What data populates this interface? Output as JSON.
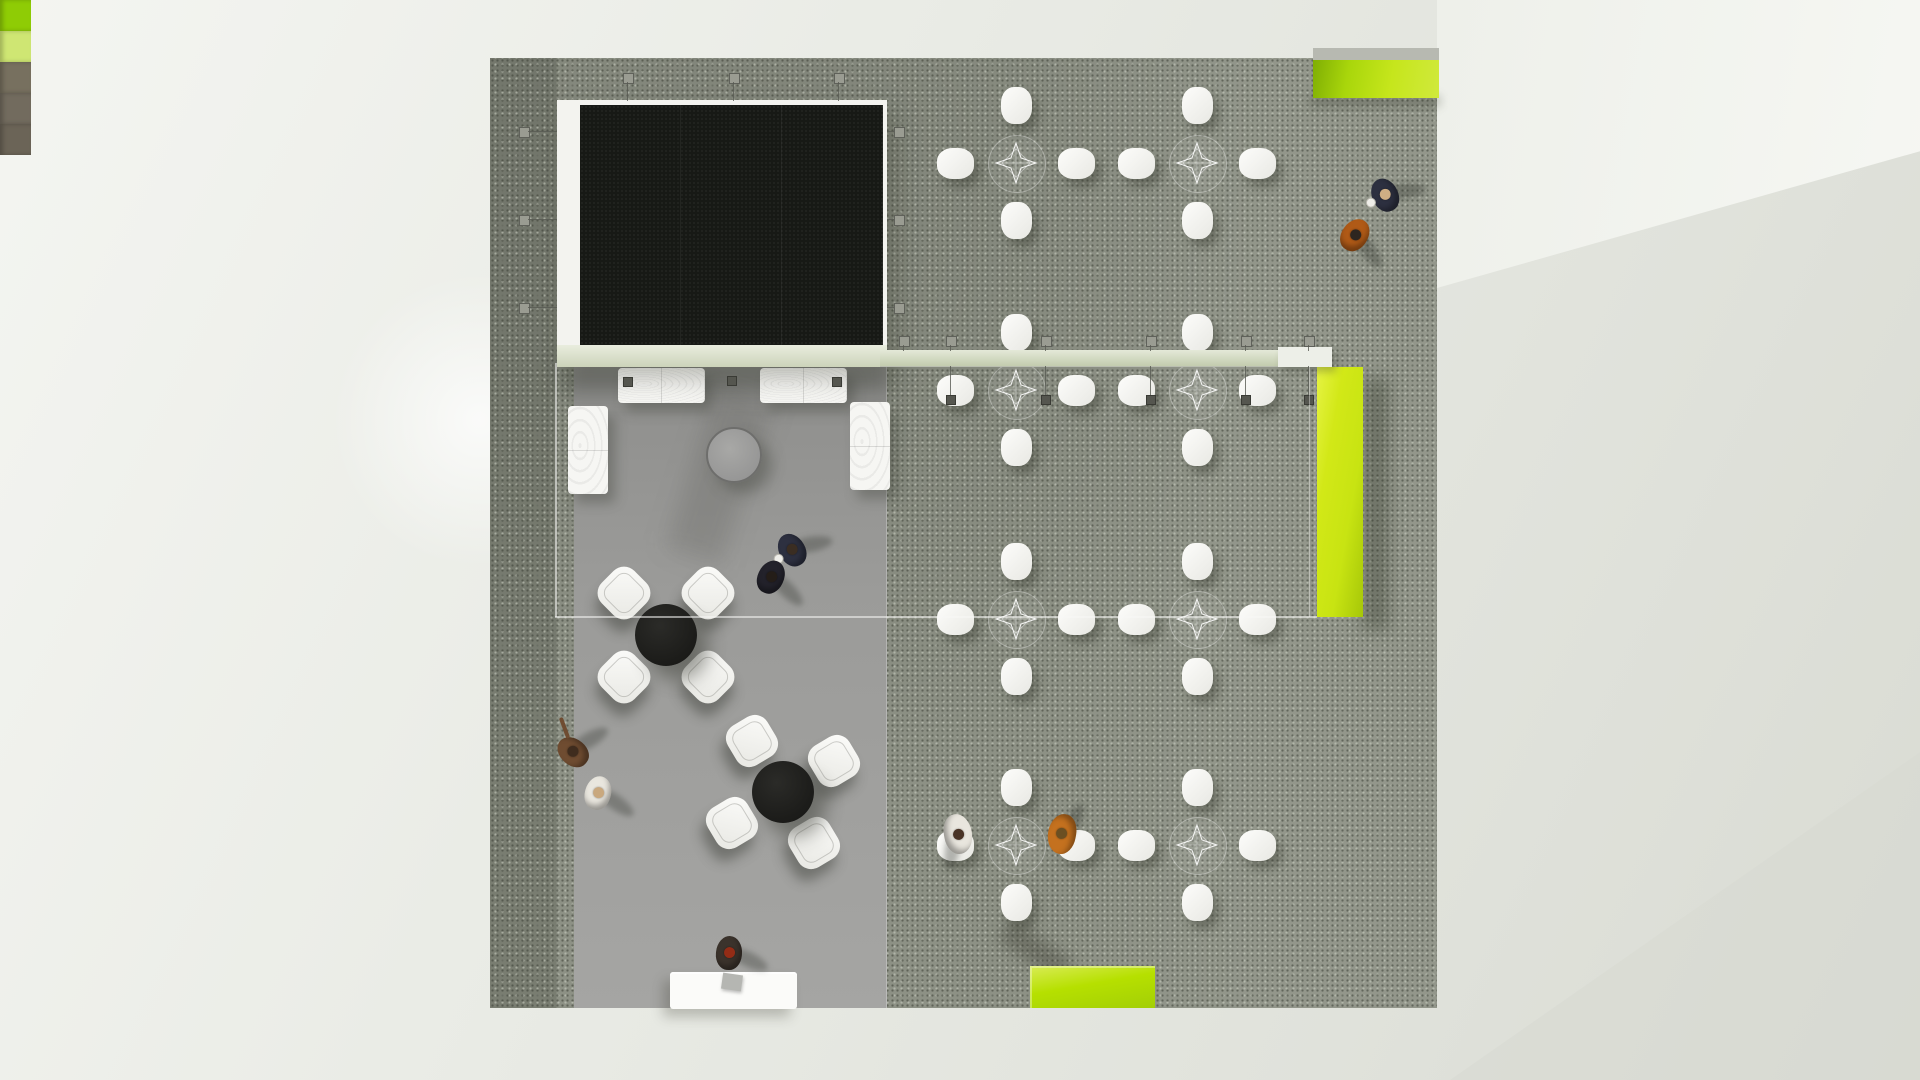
{
  "scene": {
    "description": "Top-down 3D architectural render of an exhibition booth lounge with LED screen stage, glass meeting area, chair clusters and lime-green accent furniture",
    "people_count": 9,
    "furniture": {
      "carpet_chair_clusters": 8,
      "chairs_per_cluster": 4,
      "lounge_table_clusters": 2,
      "sofas": 4,
      "round_coffee_tables": 1,
      "reception_counters": 1,
      "green_benches": 2,
      "green_partition_walls": 1,
      "storage_cubes": 5,
      "led_screens": 1
    },
    "colors": {
      "accent_green": "#c8e412",
      "accent_green_light": "#d9ec55",
      "accent_green_dark": "#a3cf06",
      "carpet": "#8d9185",
      "platform_gray": "#9b9b99",
      "screen_black": "#171915",
      "frame_white": "#f3f3ef",
      "beam_glass": "#d6ddc6",
      "floor_light": "#e7e9e3",
      "cube_brown": "#77705f",
      "person_navy": "#2d3040",
      "person_orange": "#c4711f",
      "person_white": "#e9e6de",
      "person_brown": "#6f4c31"
    }
  }
}
